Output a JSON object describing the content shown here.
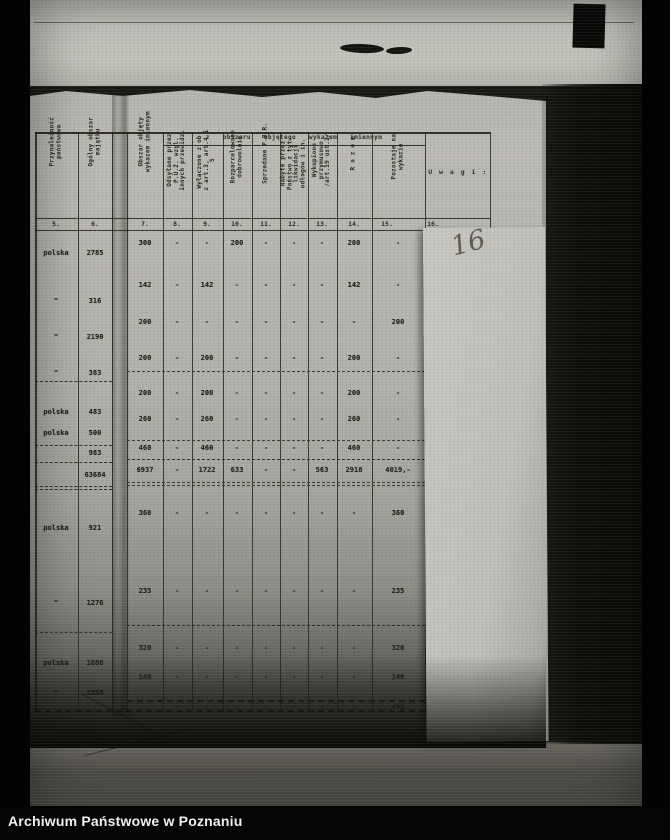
{
  "photo_caption": {
    "text": "Archiwum Państwowe w Poznaniu"
  },
  "pencil_note": {
    "text": "16"
  },
  "table": {
    "span_header": "z obszaru objętego wykazem imiennym",
    "columns": [
      {
        "no": "5.",
        "label": "Przynależność państwowa"
      },
      {
        "no": "6.",
        "label": "Ogólny obszar majątku"
      },
      {
        "no": "7.",
        "label": "Obszar objęty wykazem imiennym"
      },
      {
        "no": "8.",
        "label": "Odsyłane przez P.U.Z. wzgl. innych przewidz."
      },
      {
        "no": "9.",
        "label": "Wyłączone z ob. z art.3, art.4 i 5"
      },
      {
        "no": "10.",
        "label": "Rozparcelowane dobrowolnie"
      },
      {
        "no": "11.",
        "label": "Sprzedane P.B.R."
      },
      {
        "no": "12.",
        "label": "Nabyte przez Państwo z tyt. likwidacji odłogów i in."
      },
      {
        "no": "13.",
        "label": "Wykupione przymusowo /art.19 ust.2/"
      },
      {
        "no": "14.",
        "label": "R a z e m"
      },
      {
        "no": "15.",
        "label": "Pozostaje na wykazie"
      },
      {
        "no": "16.",
        "label": "U w a g i :"
      }
    ],
    "left_rows": [
      [
        "polska",
        "2785"
      ],
      [
        "\"",
        "316"
      ],
      [
        "\"",
        "2190"
      ],
      [
        "\"",
        "383"
      ],
      [
        "polska",
        "483"
      ],
      [
        "polska",
        "500"
      ],
      [
        "",
        "983"
      ],
      [
        "",
        "63684"
      ],
      [
        "polska",
        "921"
      ],
      [
        "\"",
        "1276"
      ],
      [
        "polska",
        "1086"
      ],
      [
        "\"",
        "2356"
      ]
    ],
    "rows": [
      [
        "300",
        "-",
        "-",
        "200",
        "-",
        "-",
        "-",
        "200",
        "-"
      ],
      [
        "142",
        "-",
        "142",
        "-",
        "-",
        "-",
        "-",
        "142",
        "-"
      ],
      [
        "200",
        "-",
        "-",
        "-",
        "-",
        "-",
        "-",
        "-",
        "200"
      ],
      [
        "200",
        "-",
        "200",
        "-",
        "-",
        "-",
        "-",
        "200",
        "-"
      ],
      [
        "200",
        "-",
        "200",
        "-",
        "-",
        "-",
        "-",
        "200",
        "-"
      ],
      [
        "260",
        "-",
        "260",
        "-",
        "-",
        "-",
        "-",
        "260",
        "-"
      ],
      [
        "460",
        "-",
        "460",
        "-",
        "-",
        "-",
        "-",
        "460",
        "-"
      ],
      [
        "6937",
        "-",
        "1722",
        "633",
        "-",
        "-",
        "563",
        "2918",
        "4019,-"
      ],
      [
        "360",
        "-",
        "-",
        "-",
        "-",
        "-",
        "-",
        "-",
        "360"
      ],
      [
        "235",
        "-",
        "-",
        "-",
        "-",
        "-",
        "-",
        "-",
        "235"
      ],
      [
        "320",
        "-",
        "-",
        "-",
        "-",
        "-",
        "-",
        "-",
        "320"
      ],
      [
        "148",
        "-",
        "-",
        "-",
        "-",
        "-",
        "-",
        "-",
        "148"
      ],
      [
        "",
        "-",
        "-",
        "-",
        "-",
        "-",
        "-",
        "-",
        "496"
      ]
    ]
  },
  "colors": {
    "paper": "#b2b2ac",
    "under_paper": "#c4c4bf",
    "ink": "#26261f",
    "pencil": "#5f5a52",
    "background": "#030303"
  }
}
